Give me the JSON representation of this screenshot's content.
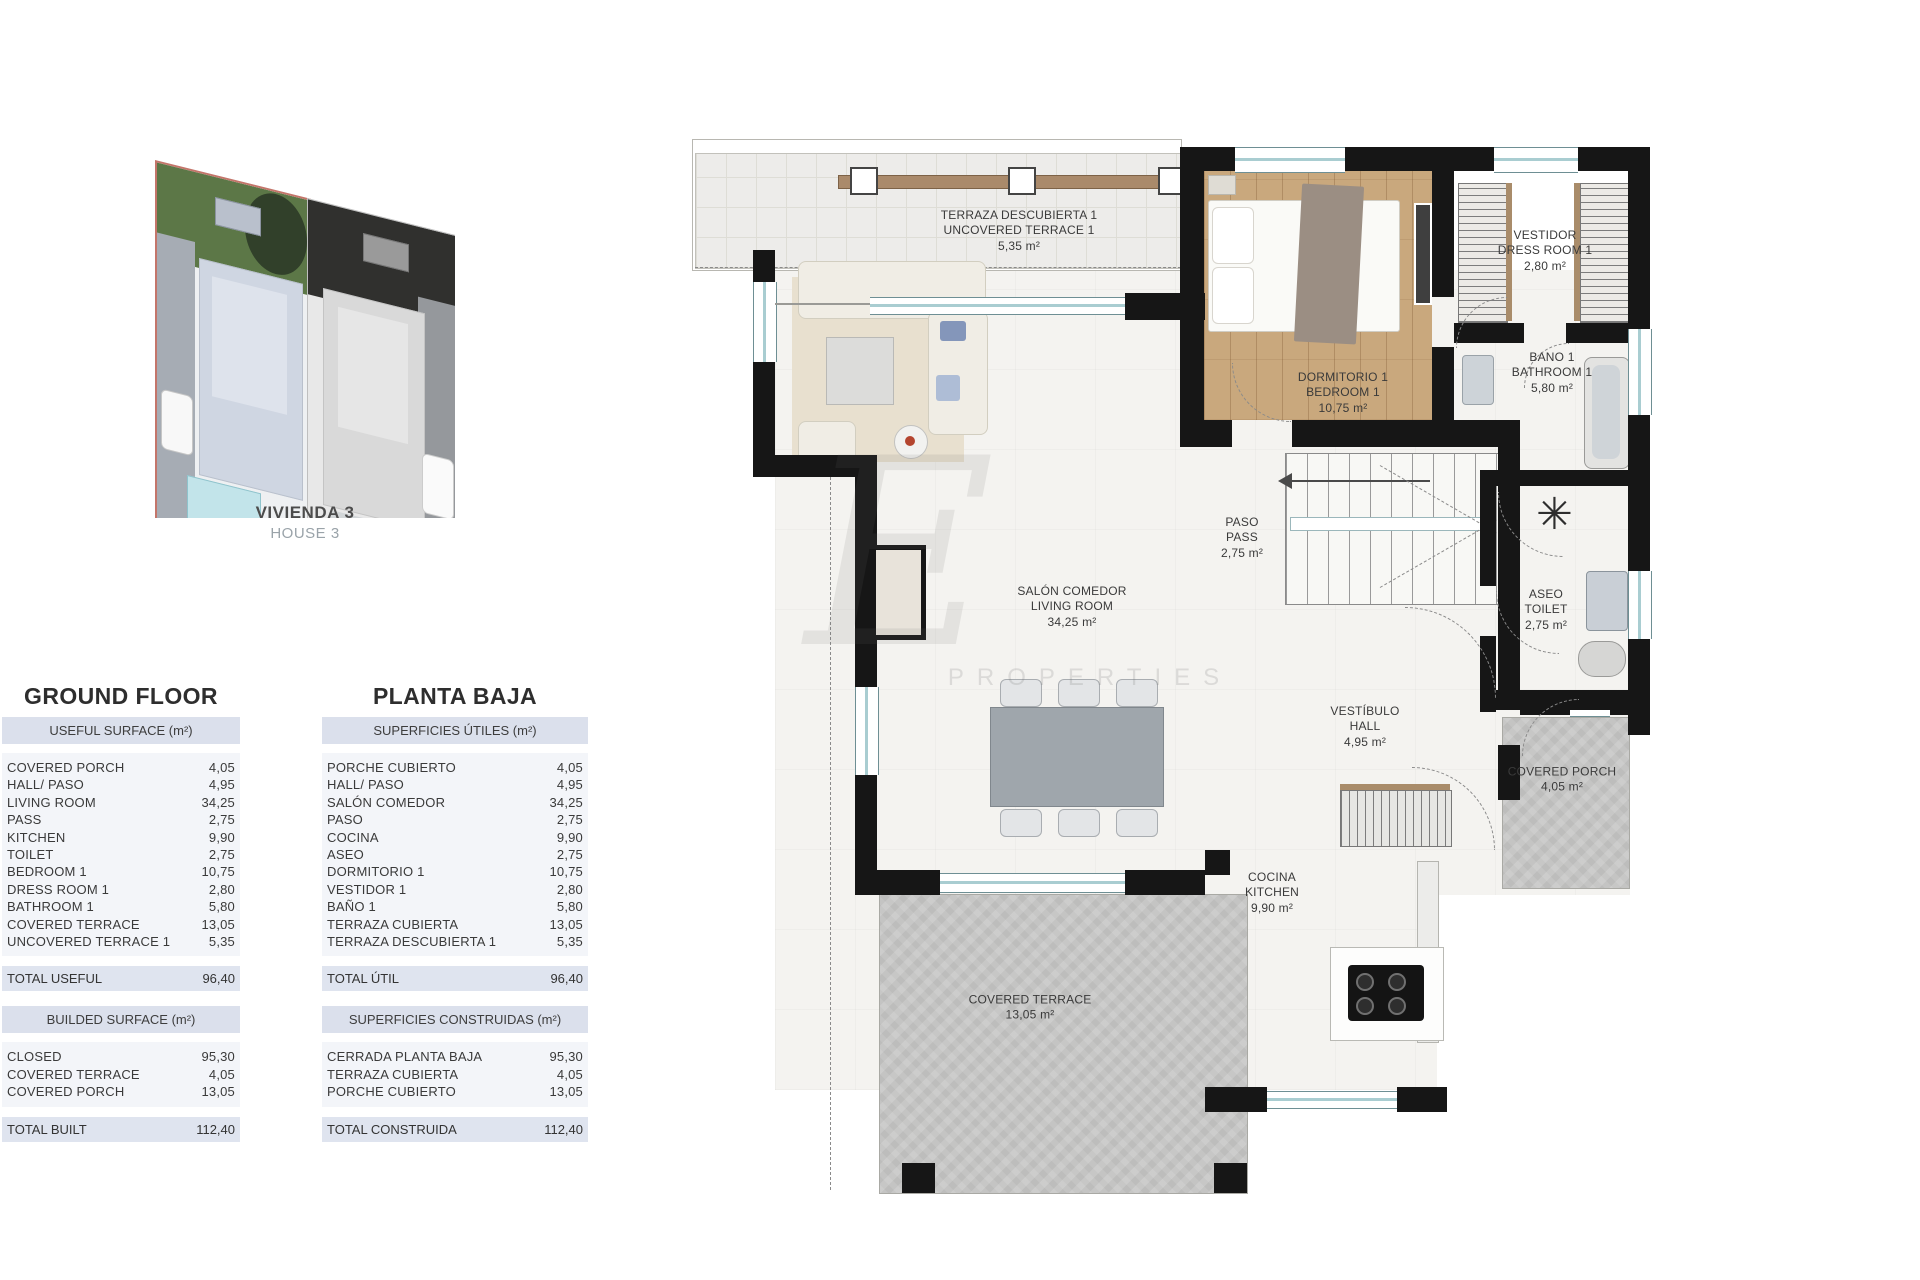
{
  "site_plan": {
    "caption_title": "VIVIENDA 3",
    "caption_subtitle": "HOUSE 3"
  },
  "watermark": {
    "initial": "E",
    "label": "PROPERTIES"
  },
  "tables": {
    "left": {
      "title": "GROUND FLOOR",
      "section1": {
        "header": "USEFUL SURFACE (m²)",
        "rows": [
          {
            "label": "COVERED PORCH",
            "value": "4,05"
          },
          {
            "label": "HALL/ PASO",
            "value": "4,95"
          },
          {
            "label": "LIVING ROOM",
            "value": "34,25"
          },
          {
            "label": "PASS",
            "value": "2,75"
          },
          {
            "label": "KITCHEN",
            "value": "9,90"
          },
          {
            "label": "TOILET",
            "value": "2,75"
          },
          {
            "label": "BEDROOM 1",
            "value": "10,75"
          },
          {
            "label": "DRESS ROOM 1",
            "value": "2,80"
          },
          {
            "label": "BATHROOM 1",
            "value": "5,80"
          },
          {
            "label": "COVERED TERRACE",
            "value": "13,05"
          },
          {
            "label": "UNCOVERED TERRACE 1",
            "value": "5,35"
          }
        ],
        "total_label": "TOTAL USEFUL",
        "total_value": "96,40"
      },
      "section2": {
        "header": "BUILDED SURFACE (m²)",
        "rows": [
          {
            "label": "CLOSED",
            "value": "95,30"
          },
          {
            "label": "COVERED TERRACE",
            "value": "4,05"
          },
          {
            "label": "COVERED PORCH",
            "value": "13,05"
          }
        ],
        "total_label": "TOTAL BUILT",
        "total_value": "112,40"
      }
    },
    "right": {
      "title": "PLANTA BAJA",
      "section1": {
        "header": "SUPERFICIES ÚTILES (m²)",
        "rows": [
          {
            "label": "PORCHE CUBIERTO",
            "value": "4,05"
          },
          {
            "label": "HALL/ PASO",
            "value": "4,95"
          },
          {
            "label": "SALÓN COMEDOR",
            "value": "34,25"
          },
          {
            "label": "PASO",
            "value": "2,75"
          },
          {
            "label": "COCINA",
            "value": "9,90"
          },
          {
            "label": "ASEO",
            "value": "2,75"
          },
          {
            "label": "DORMITORIO 1",
            "value": "10,75"
          },
          {
            "label": "VESTIDOR 1",
            "value": "2,80"
          },
          {
            "label": "BAÑO 1",
            "value": "5,80"
          },
          {
            "label": "TERRAZA CUBIERTA",
            "value": "13,05"
          },
          {
            "label": "TERRAZA DESCUBIERTA 1",
            "value": "5,35"
          }
        ],
        "total_label": "TOTAL ÚTIL",
        "total_value": "96,40"
      },
      "section2": {
        "header": "SUPERFICIES CONSTRUIDAS (m²)",
        "rows": [
          {
            "label": "CERRADA PLANTA BAJA",
            "value": "95,30"
          },
          {
            "label": "TERRAZA CUBIERTA",
            "value": "4,05"
          },
          {
            "label": "PORCHE CUBIERTO",
            "value": "13,05"
          }
        ],
        "total_label": "TOTAL CONSTRUIDA",
        "total_value": "112,40"
      }
    }
  },
  "floor_plan": {
    "rooms": {
      "uncovered_terrace": {
        "es": "TERRAZA DESCUBIERTA 1",
        "en": "UNCOVERED TERRACE 1",
        "area": "5,35 m²"
      },
      "bedroom": {
        "es": "DORMITORIO 1",
        "en": "BEDROOM 1",
        "area": "10,75 m²"
      },
      "dress_room": {
        "es": "VESTIDOR",
        "en": "DRESS ROOM 1",
        "area": "2,80 m²"
      },
      "bathroom": {
        "es": "BANO 1",
        "en": "BATHROOM 1",
        "area": "5,80 m²"
      },
      "pass": {
        "es": "PASO",
        "en": "PASS",
        "area": "2,75 m²"
      },
      "toilet": {
        "es": "ASEO",
        "en": "TOILET",
        "area": "2,75 m²"
      },
      "living_room": {
        "es": "SALÓN COMEDOR",
        "en": "LIVING ROOM",
        "area": "34,25 m²"
      },
      "hall": {
        "es": "VESTÍBULO",
        "en": "HALL",
        "area": "4,95 m²"
      },
      "covered_porch": {
        "es": "COVERED PORCH",
        "en": "",
        "area": "4,05 m²"
      },
      "kitchen": {
        "es": "COCINA",
        "en": "KITCHEN",
        "area": "9,90 m²"
      },
      "covered_terrace": {
        "es": "COVERED TERRACE",
        "en": "",
        "area": "13,05 m²"
      }
    },
    "symbols": {
      "shaft_star": "✳"
    }
  },
  "colors": {
    "wall": "#161616",
    "wood_floor": "#c9a87d",
    "concrete": "#c7c7c6",
    "window_teal": "#a9cdd1",
    "table_band": "#dbe0ec",
    "highlight_border": "#c4756a"
  }
}
